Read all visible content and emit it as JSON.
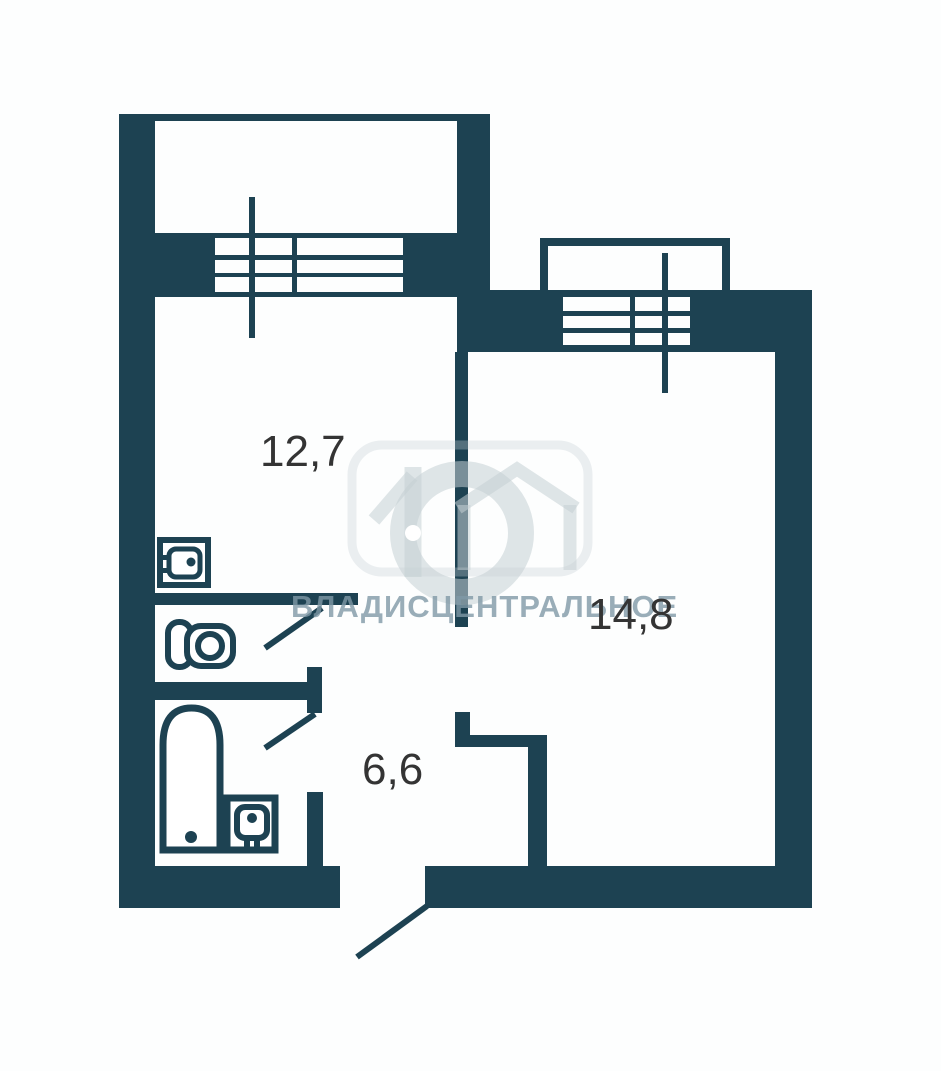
{
  "plan": {
    "kind": "apartment-floor-plan"
  },
  "colors": {
    "wall": "#1d4252",
    "background": "#fdfefe",
    "room_fill": "#ffffff",
    "label": "#343434",
    "watermark_text": "rgba(128,152,166,0.8)",
    "watermark_logo": "rgba(197,207,212,0.55)"
  },
  "rooms": [
    {
      "id": "room-left",
      "area_label": "12,7"
    },
    {
      "id": "room-right",
      "area_label": "14,8"
    },
    {
      "id": "hallway",
      "area_label": "6,6"
    }
  ],
  "watermark": {
    "text": "ВЛАДИСЦЕНТРАЛЬНОЕ"
  },
  "icons": [
    "kitchen-sink-icon",
    "toilet-icon",
    "bathtub-icon",
    "washbasin-icon",
    "window-icon",
    "door-leaf-icon",
    "house-logo-icon"
  ]
}
